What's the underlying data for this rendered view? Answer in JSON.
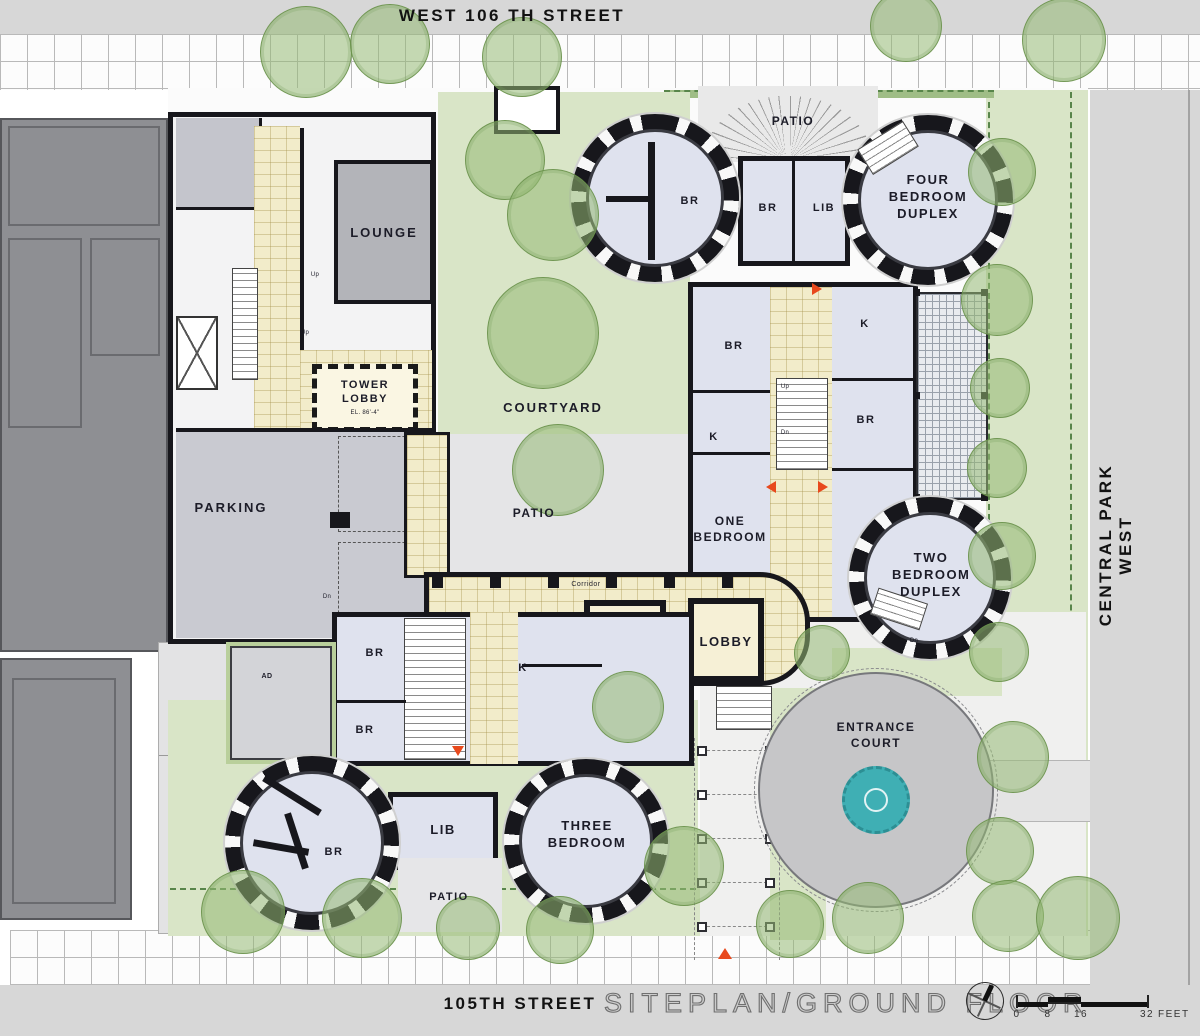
{
  "streets": {
    "north": "WEST 106 TH STREET",
    "east": "CENTRAL PARK WEST",
    "south": "105TH STREET"
  },
  "titleblock": {
    "title": "SITEPLAN/GROUND FLOOR",
    "scale_ticks": [
      "0",
      "8",
      "16",
      "32"
    ],
    "scale_unit": "FEET"
  },
  "rooms": {
    "lounge": "LOUNGE",
    "tower_lobby": "TOWER LOBBY",
    "tower_lobby_elevation": "EL. 86'-4\"",
    "parking": "PARKING",
    "courtyard": "COURTYARD",
    "patio": "PATIO",
    "corridor": "Corridor",
    "lobby": "LOBBY",
    "one_bedroom": "ONE BEDROOM",
    "two_bedroom_duplex": "TWO BEDROOM DUPLEX",
    "three_bedroom": "THREE BEDROOM",
    "four_bedroom_duplex": "FOUR BEDROOM DUPLEX",
    "entrance_court": "ENTRANCE COURT",
    "bedroom_abbr": "BR",
    "library_abbr": "LIB",
    "kitchen_abbr": "K",
    "ramp_down": "RAMP DOWN",
    "stair_up": "Up",
    "stair_down": "Dn",
    "annex": "AD"
  },
  "colors": {
    "room_fill": "#dfe2ee",
    "corridor_tan": "#f2ecca",
    "courtyard_green": "#d9e5c7",
    "tree_green": "#96ba74",
    "street_gray": "#d7d7d7",
    "fountain_teal": "#3fafb4",
    "entrance_marker": "#e8491d"
  }
}
